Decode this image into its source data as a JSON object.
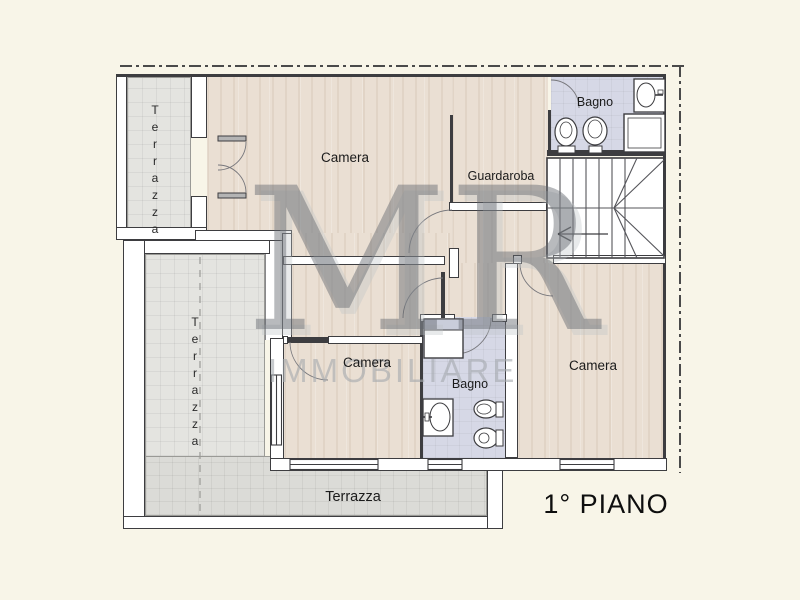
{
  "labels": {
    "camera_top": "Camera",
    "guardaroba": "Guardaroba",
    "bagno_top": "Bagno",
    "camera_mid": "Camera",
    "bagno_bottom": "Bagno",
    "camera_right": "Camera",
    "terrace_top_left": "Terrazza",
    "terrace_left": "Terrazza",
    "terrace_bottom": "Terrazza",
    "floor_title": "1° PIANO"
  },
  "watermark": {
    "initials": "MR",
    "company": "IMMOBILIARE"
  },
  "colors": {
    "background": "#f8f5e8",
    "wood_floor": "#eadfd3",
    "bath_floor": "#d6d8e6",
    "terrace_tile": "#e4e4e0",
    "terrace_tile_dark": "#dbdbd7",
    "wall_outline": "#3d3d40",
    "watermark_gray": "#62676c",
    "watermark_light_gray": "#a3a8ad"
  },
  "icons": {
    "fixtures": [
      "sink-icon",
      "shower-icon",
      "toilet-icon",
      "bidet-icon"
    ],
    "stairs": "stairs-icon",
    "direction_arrow": "stairs-direction-arrow-icon"
  }
}
